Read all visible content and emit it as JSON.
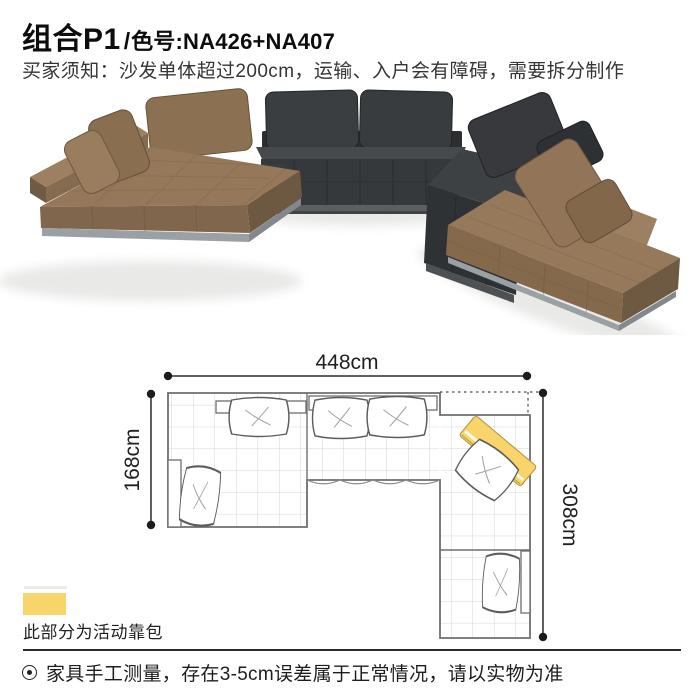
{
  "page": {
    "background": "#ffffff"
  },
  "header": {
    "title_main": "组合P1",
    "title_divider": "/",
    "title_code": "色号:NA426+NA407",
    "notice": "买家须知：沙发单体超过200cm，运输、入户会有障碍，需要拆分制作"
  },
  "product_image": {
    "alt": "U型组合沙发（棕色+深灰色模块沙发）渲染图",
    "colors": {
      "leather_brown": "#95785a",
      "leather_brown_dark": "#6d5942",
      "leather_charcoal": "#393c3f",
      "leather_charcoal_dark": "#2f3234",
      "plinth_metal": "#9ba0a3"
    }
  },
  "plan": {
    "width_label": "448cm",
    "left_depth_label": "168cm",
    "right_depth_label": "308cm",
    "highlight_color": "#f8d56b"
  },
  "legend": {
    "swatch_color": "#f8d56b",
    "label": "此部分为活动靠包"
  },
  "footer": {
    "note": "家具手工测量，存在3-5cm误差属于正常情况，请以实物为准"
  }
}
